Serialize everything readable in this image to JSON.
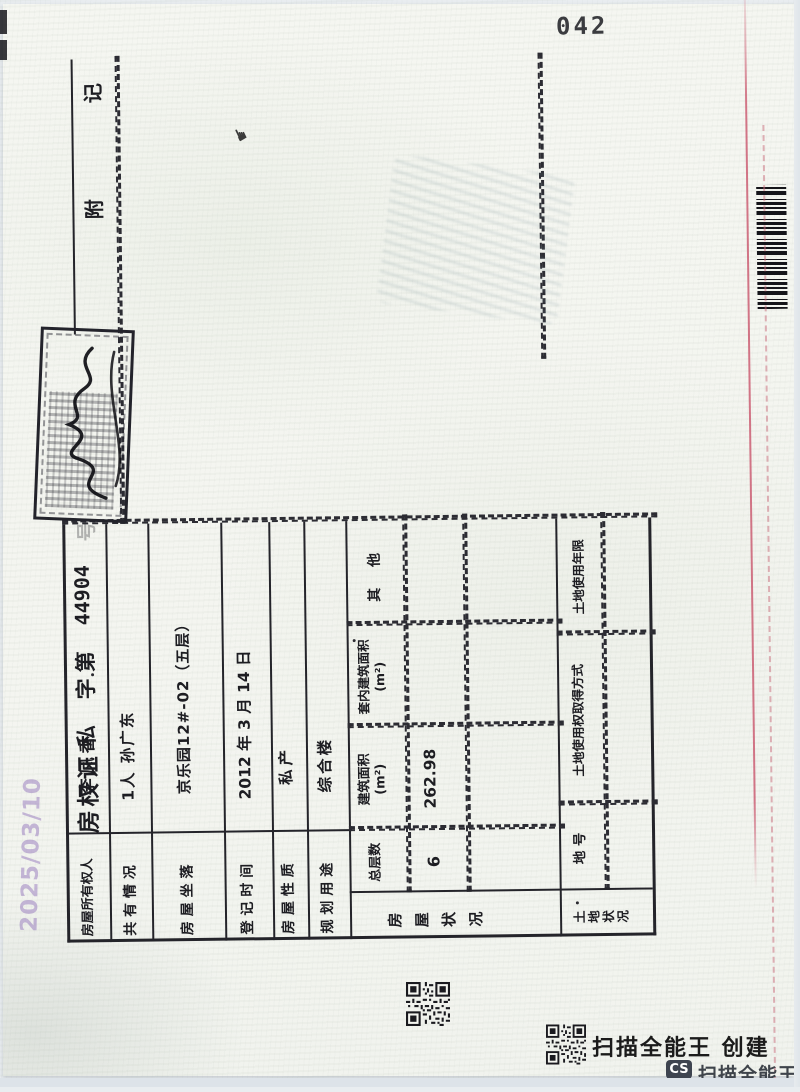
{
  "page_number": "042",
  "scan_date_watermark": "2025/03/10",
  "certificate": {
    "title": {
      "doc_type": "房权证",
      "category": "私",
      "zi_di": "字第",
      "number": "44904",
      "hao": "号"
    },
    "rows": [
      {
        "label": "房屋所有权人",
        "value": "李凤香"
      },
      {
        "label": "共 有 情 况",
        "value": "1人 孙广东"
      },
      {
        "label": "房 屋 坐 落",
        "value": "京乐园12#-02（五层）"
      },
      {
        "label": "登 记 时 间",
        "value": "2012 年 3 月 14 日"
      },
      {
        "label": "房 屋 性 质",
        "value": "私产"
      },
      {
        "label": "规 划 用 途",
        "value": "综合楼"
      }
    ],
    "house_status": {
      "group_label": "房屋状况",
      "col_total_floors": "总层数",
      "col_floor_area": "建筑面积",
      "col_floor_area_unit": "(m²)",
      "col_inner_area": "套内建筑面积",
      "col_inner_area_unit": "(m²)",
      "col_other": "其 他",
      "total_floors": "6",
      "floor_area": "262.98",
      "inner_area": "",
      "other": ""
    },
    "land_status": {
      "group_label": "土地状况",
      "col_land_no": "地 号",
      "col_acquisition": "土地使用权取得方式",
      "col_tenure": "土地使用年限"
    },
    "remarks_title": "附记"
  },
  "footer": {
    "app_caption": "扫描全能王 创建",
    "badge": "CS",
    "badge_caption": "扫描全能王"
  }
}
